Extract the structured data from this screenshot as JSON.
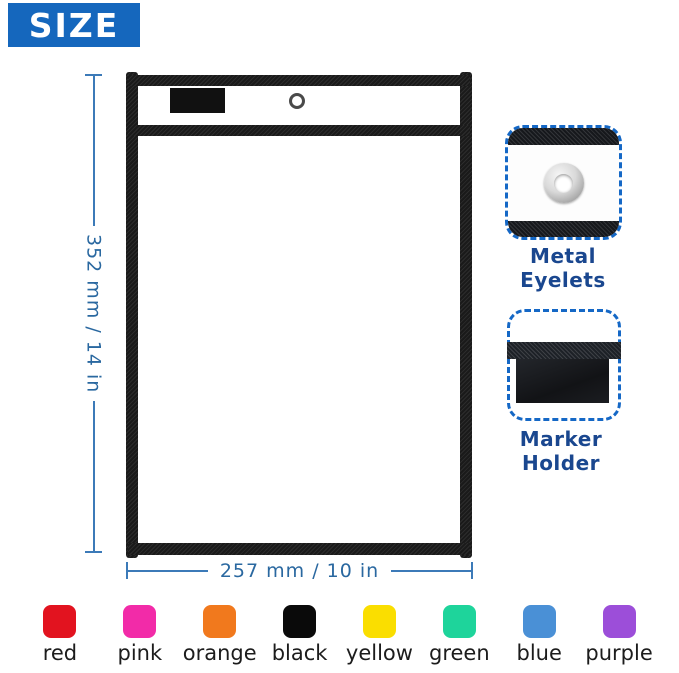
{
  "banner": {
    "title": "SIZE"
  },
  "diagram": {
    "height_dimension": "352 mm / 14 in",
    "width_dimension": "257 mm / 10 in"
  },
  "callouts": {
    "eyelet": {
      "label": "Metal Eyelets"
    },
    "marker": {
      "label": "Marker Holder"
    }
  },
  "swatches": {
    "items": [
      {
        "name": "red",
        "hex": "#e2131f"
      },
      {
        "name": "pink",
        "hex": "#f22ba8"
      },
      {
        "name": "orange",
        "hex": "#f1791d"
      },
      {
        "name": "black",
        "hex": "#0a0a0a"
      },
      {
        "name": "yellow",
        "hex": "#fade00"
      },
      {
        "name": "green",
        "hex": "#1ed49b"
      },
      {
        "name": "blue",
        "hex": "#4a90d6"
      },
      {
        "name": "purple",
        "hex": "#9c4ed9"
      }
    ]
  },
  "theme": {
    "banner_blue": "#1567bd",
    "dimension_blue": "#3c7ab8",
    "label_navy": "#1a478f",
    "dashed_border_blue": "#1568c6"
  }
}
